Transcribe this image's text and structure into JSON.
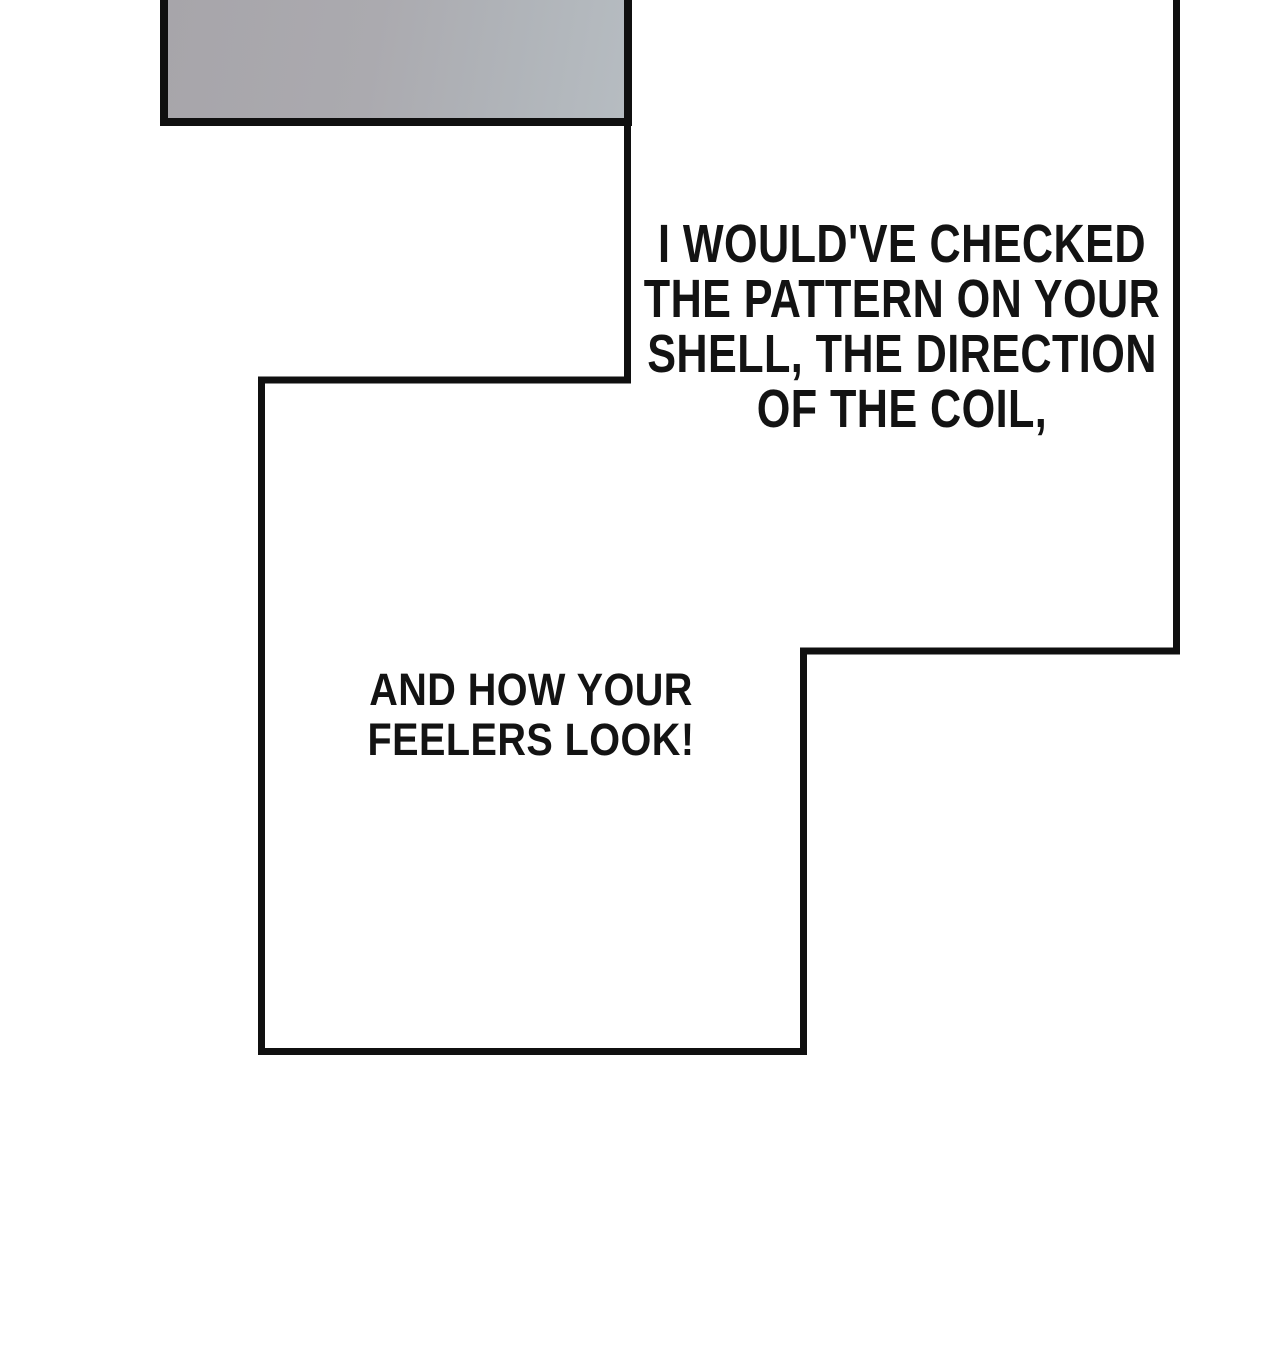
{
  "page": {
    "background_color": "#ffffff",
    "ink_color": "#101010"
  },
  "previous_panel_fragment": {
    "fill_color_left": "#a7a5aa",
    "fill_color_right": "#b6bcc1",
    "border_color": "#101010"
  },
  "dialogue": {
    "bubble1": {
      "text": "I WOULD'VE CHECKED\nTHE PATTERN ON YOUR\nSHELL, THE DIRECTION\nOF THE COIL,"
    },
    "bubble2": {
      "text": "AND HOW YOUR\nFEELERS LOOK!"
    }
  }
}
